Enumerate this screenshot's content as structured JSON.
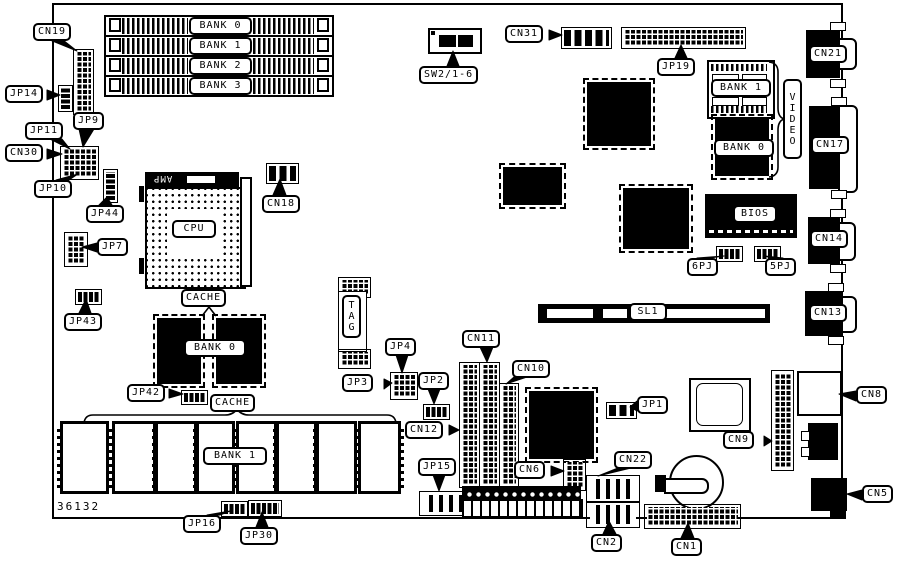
{
  "diagram": {
    "type": "motherboard-layout-diagram",
    "board_number": "36132",
    "amp_text": "AMP",
    "colors": {
      "ink": "#000000",
      "paper": "#ffffff"
    },
    "labels": [
      {
        "id": "cn19",
        "t": "CN19",
        "x": 33,
        "y": 23
      },
      {
        "id": "jp14",
        "t": "JP14",
        "x": 5,
        "y": 85
      },
      {
        "id": "jp11",
        "t": "JP11",
        "x": 25,
        "y": 122
      },
      {
        "id": "jp9",
        "t": "JP9",
        "x": 73,
        "y": 112
      },
      {
        "id": "cn30",
        "t": "CN30",
        "x": 5,
        "y": 144
      },
      {
        "id": "jp10",
        "t": "JP10",
        "x": 34,
        "y": 180
      },
      {
        "id": "jp44",
        "t": "JP44",
        "x": 86,
        "y": 205
      },
      {
        "id": "jp7",
        "t": "JP7",
        "x": 97,
        "y": 238
      },
      {
        "id": "jp43",
        "t": "JP43",
        "x": 64,
        "y": 313
      },
      {
        "id": "cn18",
        "t": "CN18",
        "x": 262,
        "y": 195
      },
      {
        "id": "cpu",
        "t": "CPU",
        "x": 172,
        "y": 220,
        "w": 34
      },
      {
        "id": "cache-top",
        "t": "CACHE",
        "x": 181,
        "y": 289
      },
      {
        "id": "bank0-cache",
        "t": "BANK 0",
        "x": 184,
        "y": 339,
        "w": 52
      },
      {
        "id": "jp42",
        "t": "JP42",
        "x": 127,
        "y": 384
      },
      {
        "id": "cache-bottom",
        "t": "CACHE",
        "x": 210,
        "y": 394
      },
      {
        "id": "bank1-cache",
        "t": "BANK 1",
        "x": 203,
        "y": 447,
        "w": 54
      },
      {
        "id": "jp16",
        "t": "JP16",
        "x": 183,
        "y": 515
      },
      {
        "id": "jp30",
        "t": "JP30",
        "x": 240,
        "y": 527
      },
      {
        "id": "tag",
        "t": "TAG",
        "x": 342,
        "y": 295,
        "v": true
      },
      {
        "id": "jp4",
        "t": "JP4",
        "x": 385,
        "y": 338
      },
      {
        "id": "jp3",
        "t": "JP3",
        "x": 342,
        "y": 374
      },
      {
        "id": "jp2",
        "t": "JP2",
        "x": 418,
        "y": 372
      },
      {
        "id": "cn12",
        "t": "CN12",
        "x": 405,
        "y": 421
      },
      {
        "id": "cn11",
        "t": "CN11",
        "x": 462,
        "y": 330
      },
      {
        "id": "cn10",
        "t": "CN10",
        "x": 512,
        "y": 360
      },
      {
        "id": "cn6",
        "t": "CN6",
        "x": 514,
        "y": 461
      },
      {
        "id": "jp15",
        "t": "JP15",
        "x": 418,
        "y": 458
      },
      {
        "id": "sw2",
        "t": "SW2/1-6",
        "x": 419,
        "y": 66
      },
      {
        "id": "cn31",
        "t": "CN31",
        "x": 505,
        "y": 25
      },
      {
        "id": "jp19",
        "t": "JP19",
        "x": 657,
        "y": 58
      },
      {
        "id": "bank1-video",
        "t": "BANK 1",
        "x": 711,
        "y": 79,
        "w": 50
      },
      {
        "id": "bank0-video",
        "t": "BANK 0",
        "x": 714,
        "y": 139,
        "w": 50
      },
      {
        "id": "video",
        "t": "VIDEO",
        "x": 783,
        "y": 79,
        "v": true,
        "h": 70
      },
      {
        "id": "bios",
        "t": "BIOS",
        "x": 733,
        "y": 205,
        "w": 34
      },
      {
        "id": "pj6",
        "t": "6PJ",
        "x": 687,
        "y": 258
      },
      {
        "id": "pj5",
        "t": "5PJ",
        "x": 765,
        "y": 258
      },
      {
        "id": "sl1",
        "t": "SL1",
        "x": 629,
        "y": 303,
        "w": 28
      },
      {
        "id": "cn21",
        "t": "CN21",
        "x": 809,
        "y": 45
      },
      {
        "id": "cn17",
        "t": "CN17",
        "x": 811,
        "y": 136
      },
      {
        "id": "cn14",
        "t": "CN14",
        "x": 810,
        "y": 230
      },
      {
        "id": "cn13",
        "t": "CN13",
        "x": 809,
        "y": 304
      },
      {
        "id": "cn8",
        "t": "CN8",
        "x": 856,
        "y": 386
      },
      {
        "id": "jp1",
        "t": "JP1",
        "x": 637,
        "y": 396
      },
      {
        "id": "cn9",
        "t": "CN9",
        "x": 723,
        "y": 431
      },
      {
        "id": "cn22",
        "t": "CN22",
        "x": 614,
        "y": 451
      },
      {
        "id": "cn5",
        "t": "CN5",
        "x": 862,
        "y": 485
      },
      {
        "id": "cn2",
        "t": "CN2",
        "x": 591,
        "y": 534
      },
      {
        "id": "cn1",
        "t": "CN1",
        "x": 671,
        "y": 538
      },
      {
        "id": "bank0-simm",
        "t": "BANK 0",
        "x": 189,
        "y": 17,
        "w": 53
      },
      {
        "id": "bank1-simm",
        "t": "BANK 1",
        "x": 189,
        "y": 37,
        "w": 53
      },
      {
        "id": "bank2-simm",
        "t": "BANK 2",
        "x": 189,
        "y": 57,
        "w": 53
      },
      {
        "id": "bank3-simm",
        "t": "BANK 3",
        "x": 189,
        "y": 77,
        "w": 53
      }
    ]
  }
}
